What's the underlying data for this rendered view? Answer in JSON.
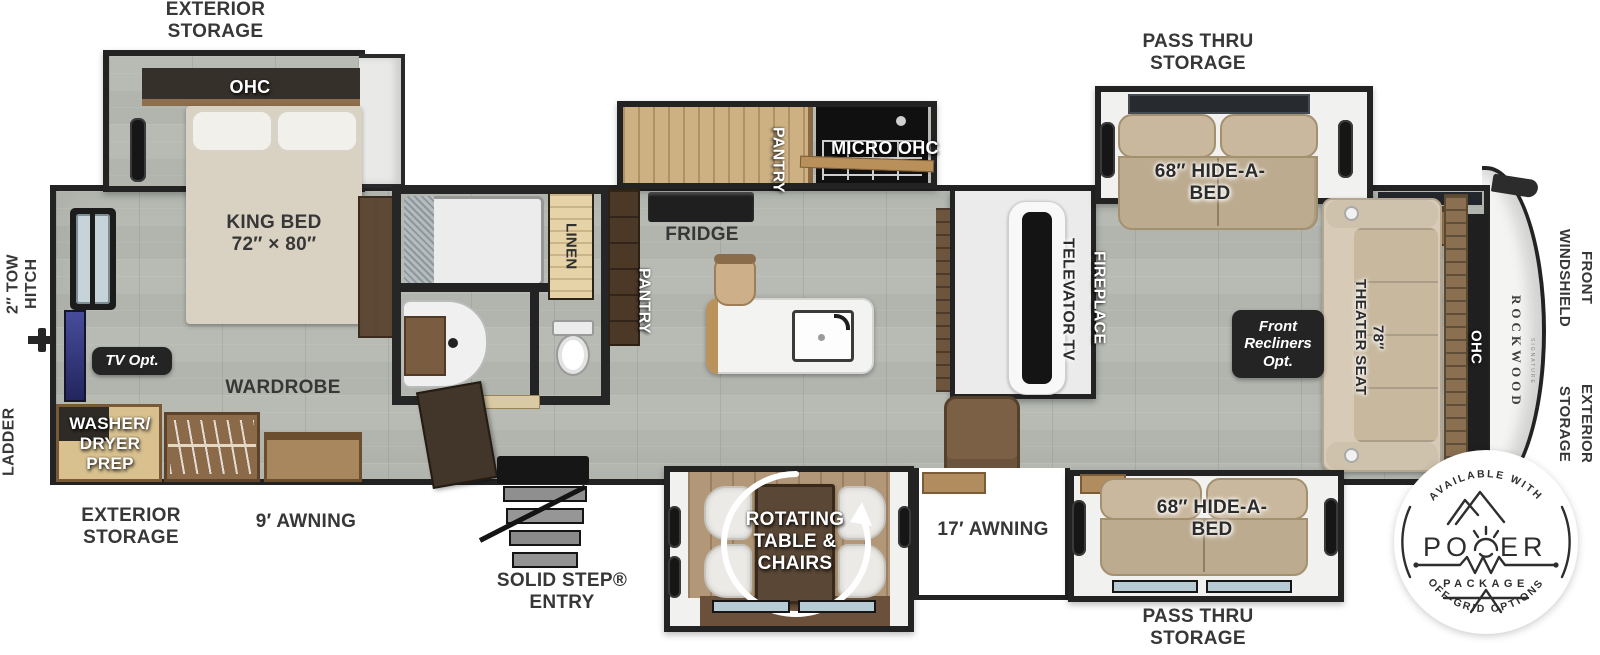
{
  "colors": {
    "wall": "#232323",
    "floor": "#b5b9b2",
    "wood": "#8a6b4c",
    "wood_light": "#cdb183",
    "sofa": "#c4b298",
    "tan_floor": "#b29878",
    "tv_blue": "#3b3f8d",
    "label": "#373737",
    "badge_bg": "#242424"
  },
  "exterior": {
    "tow_hitch": "2″ TOW\nHITCH",
    "ladder": "LADDER",
    "storage_top": "EXTERIOR\nSTORAGE",
    "storage_bottom": "EXTERIOR\nSTORAGE",
    "storage_front": "EXTERIOR\nSTORAGE",
    "front_windshield": "FRONT\nWINDSHIELD",
    "pass_thru_top": "PASS THRU\nSTORAGE",
    "pass_thru_bottom": "PASS THRU\nSTORAGE",
    "awning_rear": "9′ AWNING",
    "awning_main": "17′ AWNING",
    "entry": "SOLID STEP®\nENTRY"
  },
  "bedroom": {
    "ohc": "OHC",
    "bed": "KING BED\n72″ × 80″",
    "tv": "TV Opt.",
    "wardrobe": "WARDROBE",
    "washer": "WASHER/\nDRYER\nPREP"
  },
  "bathroom": {
    "linen": "LINEN"
  },
  "kitchen": {
    "pantry_slide": "PANTRY",
    "micro": "MICRO OHC",
    "fridge": "FRIDGE",
    "pantry_wall": "PANTRY"
  },
  "living": {
    "televator": "TELEVATOR TV",
    "fireplace": "FIREPLACE",
    "sofa_top": "68″ HIDE-A-\nBED",
    "sofa_bottom": "68″ HIDE-A-\nBED",
    "recliners": "Front\nRecliners\nOpt.",
    "theater": "78″\nTHEATER SEAT",
    "ohc_front": "OHC",
    "dinette": "ROTATING\nTABLE &\nCHAIRS"
  },
  "brand": {
    "name": "ROCKWOOD",
    "sub": "SIGNATURE"
  },
  "badge": {
    "top": "AVAILABLE WITH",
    "power_left": "PO",
    "power_right": "ER",
    "package": "PACKAGE",
    "bottom": "OFF-GRID OPTIONS"
  }
}
